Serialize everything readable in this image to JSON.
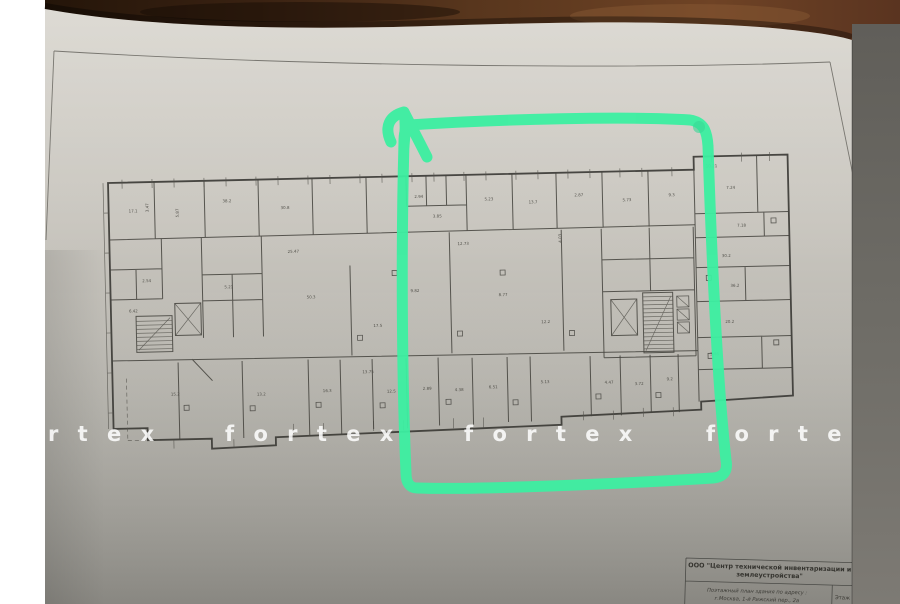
{
  "title_block": {
    "org_line1": "ООО \"Центр технической инвентаризации и",
    "org_line2": "землеустройства\"",
    "doc_line1": "Поэтажный план здания по адресу :",
    "doc_line2": "г.Москва, 1-й Рижский пер., 2а",
    "floor_label": "Этаж"
  },
  "watermark": {
    "segments": [
      "r t e x",
      "f o r t e x",
      "f o r t e x",
      "f o r t e"
    ]
  },
  "annotation": {
    "shape": "hand-drawn marker rectangle with up arrow",
    "color": "#3cefa1",
    "color_dark": "#2fd793"
  },
  "colors": {
    "white_margin": "#ffffff",
    "wood_dark": "#241509",
    "wood_mid": "#58361d",
    "wood_light": "#7b4b2a",
    "paper_light": "#d9d6cf",
    "paper_dark": "#a3a19a",
    "side_strip": "#6e6c66",
    "plan_line": "#45443f"
  },
  "plan": {
    "dimensions": [
      {
        "t": "17.1",
        "x": 20,
        "y": 30
      },
      {
        "t": "3.47",
        "x": 40,
        "y": 30,
        "r": -90
      },
      {
        "t": "5.87",
        "x": 70,
        "y": 36,
        "r": -90
      },
      {
        "t": "38.2",
        "x": 114,
        "y": 22
      },
      {
        "t": "30.8",
        "x": 172,
        "y": 30
      },
      {
        "t": "2.94",
        "x": 306,
        "y": 22
      },
      {
        "t": "3.85",
        "x": 324,
        "y": 42
      },
      {
        "t": "5.23",
        "x": 376,
        "y": 26
      },
      {
        "t": "13.7",
        "x": 420,
        "y": 30
      },
      {
        "t": "2.87",
        "x": 466,
        "y": 24
      },
      {
        "t": "5.73",
        "x": 514,
        "y": 30
      },
      {
        "t": "9.3",
        "x": 560,
        "y": 26
      },
      {
        "t": "10.21",
        "x": 598,
        "y": -2
      },
      {
        "t": "25.47",
        "x": 178,
        "y": 74
      },
      {
        "t": "12.73",
        "x": 348,
        "y": 70
      },
      {
        "t": "4.03",
        "x": 452,
        "y": 70,
        "r": -90
      },
      {
        "t": "2.54",
        "x": 32,
        "y": 100
      },
      {
        "t": "6.42",
        "x": 18,
        "y": 130
      },
      {
        "t": "5.21",
        "x": 114,
        "y": 108
      },
      {
        "t": "50.3",
        "x": 196,
        "y": 120
      },
      {
        "t": "9.82",
        "x": 300,
        "y": 116
      },
      {
        "t": "8.77",
        "x": 388,
        "y": 122
      },
      {
        "t": "17.5",
        "x": 262,
        "y": 150
      },
      {
        "t": "12.2",
        "x": 430,
        "y": 150
      },
      {
        "t": "13.75",
        "x": 250,
        "y": 196
      },
      {
        "t": "15.2",
        "x": 58,
        "y": 214
      },
      {
        "t": "13.2",
        "x": 144,
        "y": 216
      },
      {
        "t": "16.3",
        "x": 210,
        "y": 214
      },
      {
        "t": "12.5",
        "x": 274,
        "y": 216
      },
      {
        "t": "2.89",
        "x": 310,
        "y": 214
      },
      {
        "t": "4.38",
        "x": 342,
        "y": 216
      },
      {
        "t": "6.51",
        "x": 376,
        "y": 214
      },
      {
        "t": "5.13",
        "x": 428,
        "y": 210
      },
      {
        "t": "4.47",
        "x": 492,
        "y": 212
      },
      {
        "t": "3.72",
        "x": 522,
        "y": 214
      },
      {
        "t": "9.2",
        "x": 554,
        "y": 210
      },
      {
        "t": "7.24",
        "x": 618,
        "y": 20
      },
      {
        "t": "7.18",
        "x": 628,
        "y": 58
      },
      {
        "t": "30.2",
        "x": 612,
        "y": 88
      },
      {
        "t": "36.2",
        "x": 620,
        "y": 118
      },
      {
        "t": "20.2",
        "x": 614,
        "y": 154
      },
      {
        "t": "3.46",
        "x": 598,
        "y": 186
      }
    ]
  }
}
